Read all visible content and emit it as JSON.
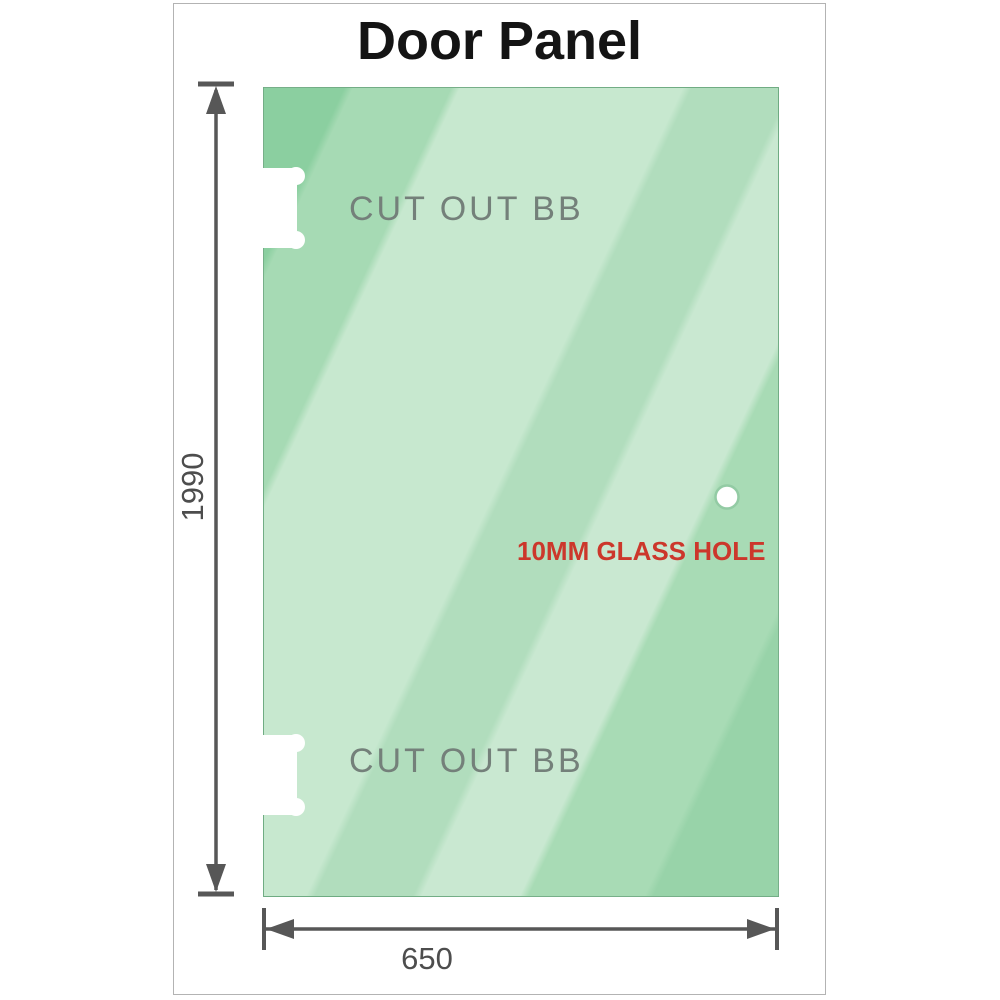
{
  "title": "Door Panel",
  "panel": {
    "cutout_top_label": "CUT OUT BB",
    "cutout_bottom_label": "CUT OUT BB",
    "hole_label": "10MM GLASS HOLE"
  },
  "dimensions": {
    "height_label": "1990",
    "width_label": "650"
  },
  "colors": {
    "glass_green_dark": "#8bcfa0",
    "glass_green_light": "#c9e8d1",
    "hole_label_red": "#cc372b",
    "cutout_label_gray": "#74807a",
    "dimension_line_gray": "#575757",
    "frame_gray": "#b3b3b3"
  }
}
